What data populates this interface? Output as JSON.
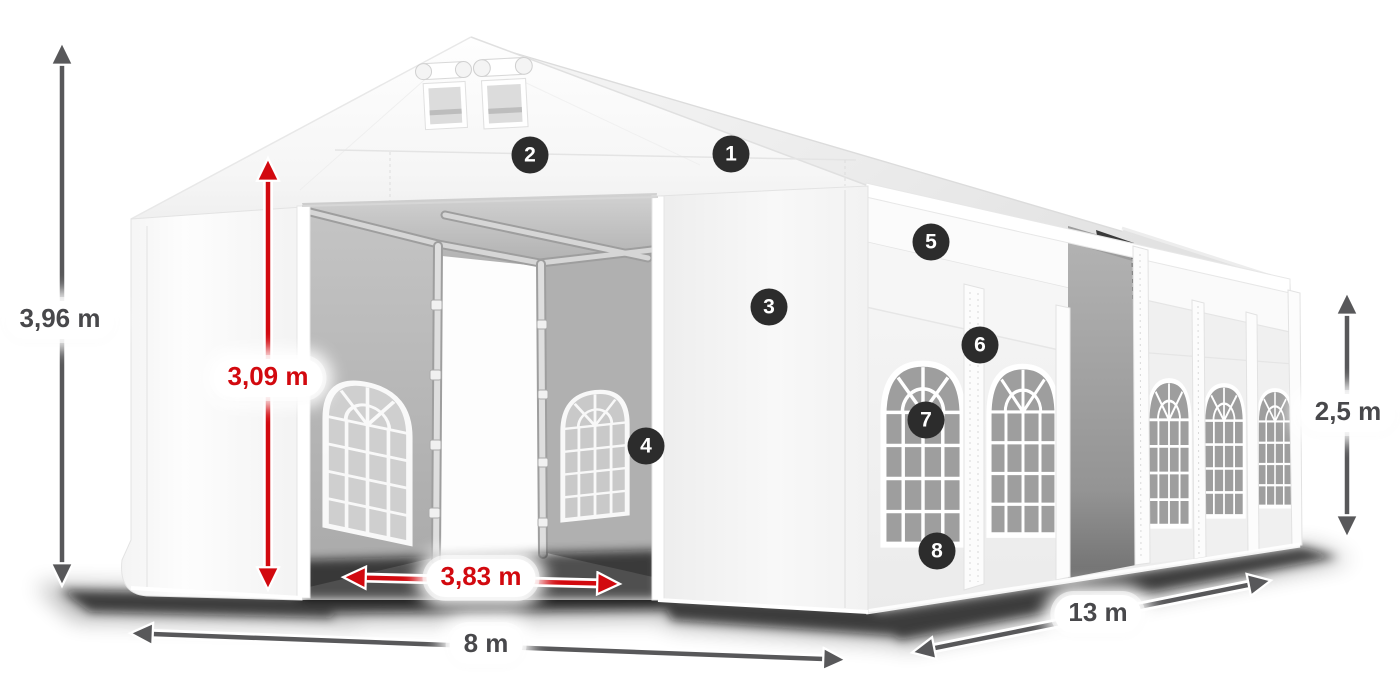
{
  "dimensions": {
    "total_height": {
      "text": "3,96 m",
      "color": "#48484b"
    },
    "entrance_height": {
      "text": "3,09 m",
      "color": "#d2090f"
    },
    "entrance_width": {
      "text": "3,83 m",
      "color": "#d2090f"
    },
    "ground_width": {
      "text": "8 m",
      "color": "#48484b"
    },
    "length": {
      "text": "13 m",
      "color": "#48484b"
    },
    "side_height": {
      "text": "2,5 m",
      "color": "#48484b"
    }
  },
  "markers": [
    {
      "label": "1"
    },
    {
      "label": "2"
    },
    {
      "label": "3"
    },
    {
      "label": "4"
    },
    {
      "label": "5"
    },
    {
      "label": "6"
    },
    {
      "label": "7"
    },
    {
      "label": "8"
    }
  ],
  "colors": {
    "dimension_red": "#d2090f",
    "dimension_dark": "#58585a",
    "marker_background": "#2c2c2c",
    "marker_text": "#ffffff"
  }
}
